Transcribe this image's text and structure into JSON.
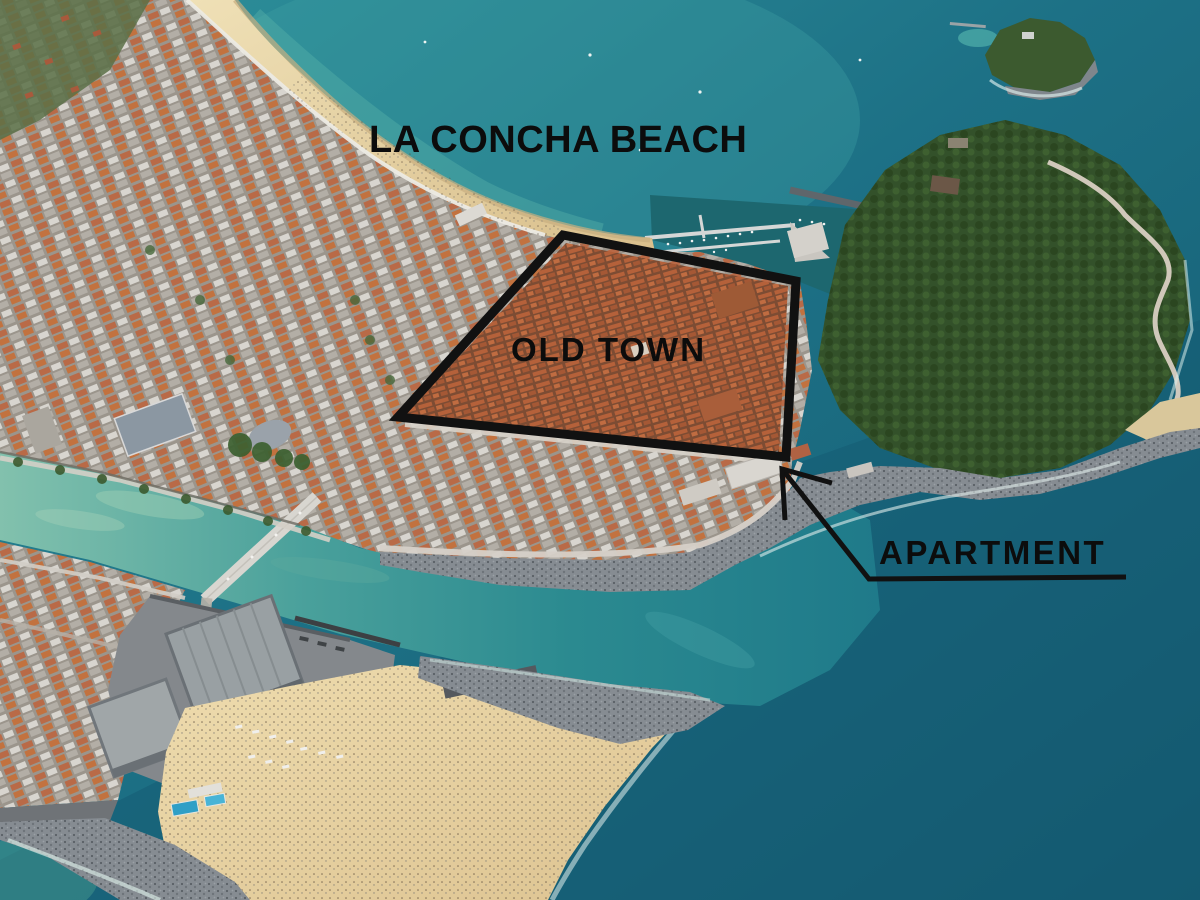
{
  "labels": {
    "beach": "LA CONCHA BEACH",
    "old_town": "OLD TOWN",
    "apartment": "APARTMENT"
  },
  "annotations": {
    "ink_color": "#111111",
    "old_town_polygon": {
      "points": "563,235 796,281 786,457 398,417"
    },
    "apartment_arrow": {
      "shaft_points": "782,469 869,579 1126,577",
      "head_points": "832,483 782,469 785,520"
    }
  },
  "scene": {
    "palette": {
      "bay_water": "#2f929b",
      "deep_sea": "#14596f",
      "river_shallow": "#82c1ad",
      "river_deep": "#1f7a8a",
      "sand": "#e7d4a4",
      "city_roofs": "#b5613a",
      "hill_green": "#33512a",
      "rocks_gray": "#868c92",
      "kursaal_gray": "#99a0a3"
    }
  }
}
